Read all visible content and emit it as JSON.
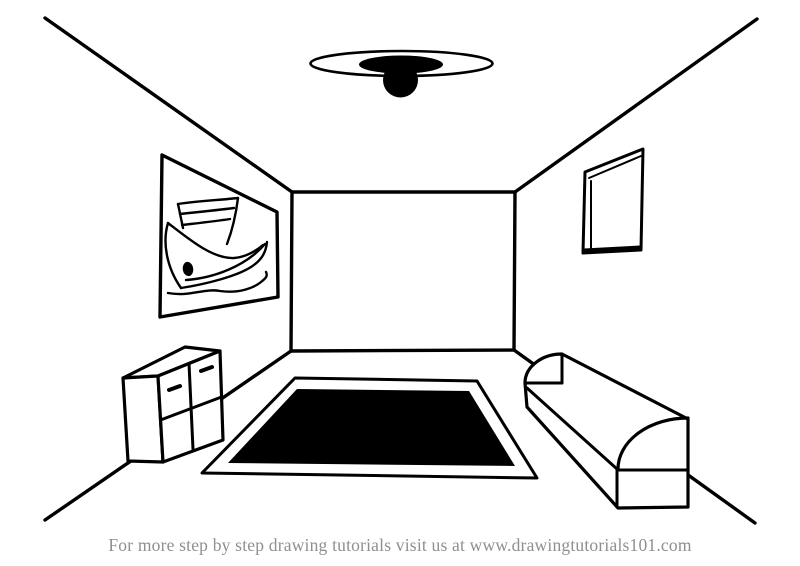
{
  "scene": {
    "type": "line-drawing",
    "background_color": "#ffffff",
    "line_color": "#000000",
    "fill_dark": "#000000",
    "objects": [
      "room-outline",
      "ceiling-light",
      "wall-painting-boat",
      "window",
      "dresser",
      "rug",
      "sofa"
    ]
  },
  "footer": {
    "caption": "For more step by step drawing tutorials visit us at www.drawingtutorials101.com",
    "text_color": "#8f8f8f"
  }
}
